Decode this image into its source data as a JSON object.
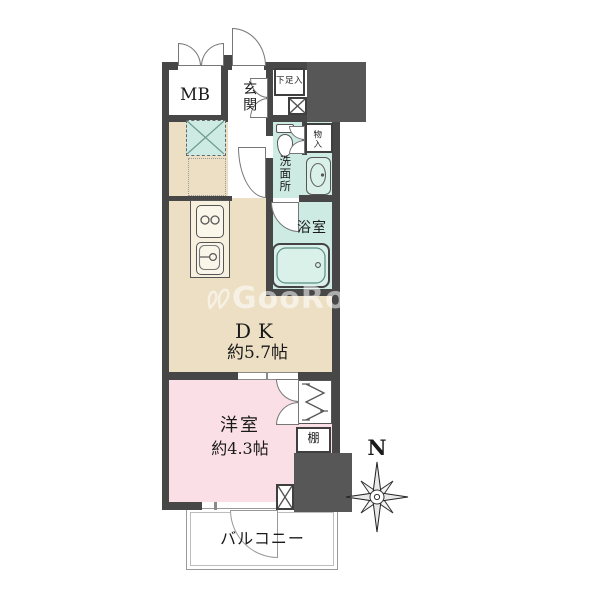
{
  "watermark": {
    "text": "GooRooM"
  },
  "compass": {
    "north_label": "N"
  },
  "rooms": {
    "mb": {
      "label": "MB"
    },
    "genkan": {
      "label": "玄関"
    },
    "shoe_storage": {
      "label": "下足入"
    },
    "storage": {
      "label": "物入"
    },
    "washroom": {
      "label": "洗面所"
    },
    "bathroom": {
      "label": "浴室"
    },
    "dining_kitchen": {
      "label": "DK",
      "size": "約5.7帖"
    },
    "western_room": {
      "label": "洋室",
      "size": "約4.3帖"
    },
    "shelf": {
      "label": "棚"
    },
    "balcony": {
      "label": "バルコニー"
    }
  },
  "colors": {
    "wall": "#474747",
    "solid_block": "#575757",
    "dk_floor": "#ecdfc3",
    "western_room_floor": "#fadfe6",
    "wet_area_floor": "#cdebe3",
    "fixture_fill": "#d9f1e9",
    "balcony_line": "#9a9a9a",
    "watermark": "rgba(255,255,255,0.55)"
  }
}
